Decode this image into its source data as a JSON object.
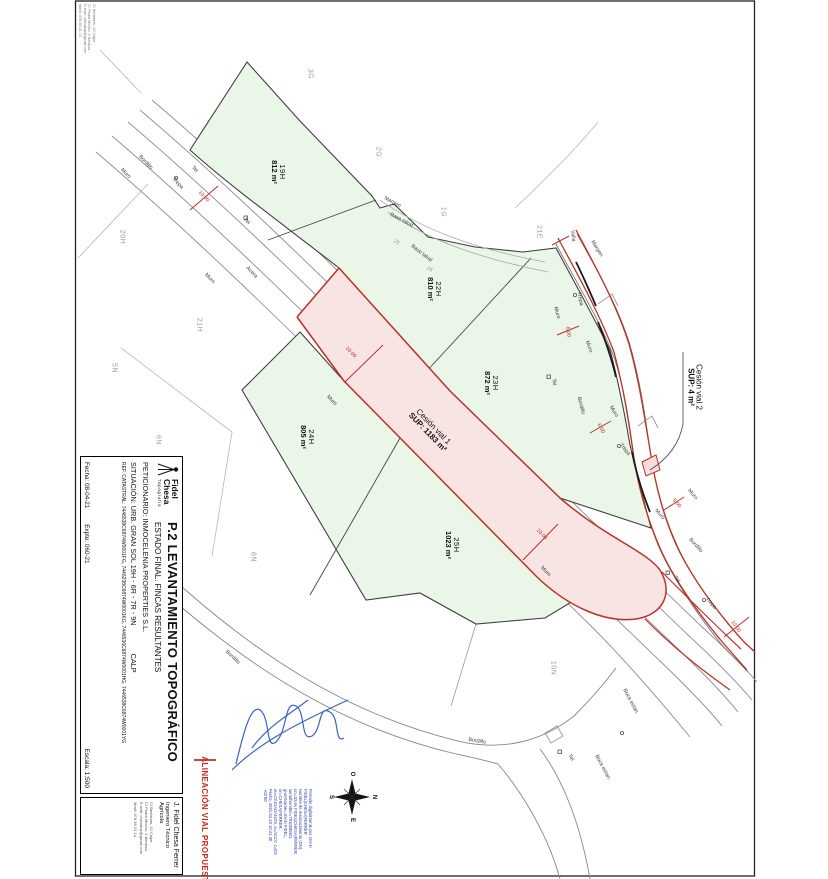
{
  "sheet": {
    "title": "P.2 LEVANTAMIENTO TOPOGRÁFICO",
    "subtitle": "ESTADO FINAL. FINCAS RESULTANTES",
    "peticionario_label": "PETICIONARIO:",
    "peticionario": "INMOCELENIA PROPERTIES S.L.",
    "situacion_label": "SITUACIÓN:",
    "situacion": "URB. GRAN SOL 19H - 6R - 7R - 9N",
    "municipio": "CALP",
    "ref_catastral_label": "REF. CATASTRAL:",
    "ref_catastral": "7446538C6874W0001FG, 7446238C6874W0001KG, 7446536C6874W0001HG, 7446538C6874W0001YG",
    "fecha_label": "Fecha:",
    "fecha": "08-04-21",
    "expte_label": "Expte:",
    "expte": "060-21",
    "escala_label": "Escala:",
    "escala": "1:500",
    "logo": {
      "name1": "Fidel",
      "name2": "Chesa",
      "tag": "Topografía"
    }
  },
  "professional": {
    "name": "J. Fidel Chesa Ferrer",
    "title": "Ingeniero Técnico Agrícola",
    "contact": [
      "C/ Benidorm, 10 Calpe",
      "C/ Pedra Mocho, 3 Benissa",
      "E-mail: chesatop@gmail.com",
      "Móvil: 678 69 21 14"
    ]
  },
  "corner_contact": {
    "lines": [
      "C/ Benidorm, 10 Calpe",
      "C/ Pedra Mocho, 3 Benissa",
      "E-mail: chesatop@gmail.com",
      "Móvil: 678 69 21 14"
    ]
  },
  "legend": {
    "label": "ALINEACIÓN VIAL PROPUESTA"
  },
  "digital_signature": {
    "lines": [
      "Firmado digitalmente por JOAN",
      "FIDEL|CHESA|FERRER",
      "Nombre de reconocimiento (DN):",
      "cn=JOAN FIDEL|CHESA|FERRER,",
      "serialNumber=79100996G,",
      "givenName=JOAN FIDEL,",
      "sn=CHESA|FERRER,",
      "ou=CIUDADANOS, o=ACCV, c=ES",
      "Fecha: 2021.04.23 10:41:30",
      "+02'00'"
    ]
  },
  "compass": {
    "n": "N",
    "s": "S",
    "e": "E",
    "w": "O"
  },
  "map": {
    "parcels": [
      {
        "id": "19H",
        "area": "812 m²",
        "x": 278,
        "y": 172
      },
      {
        "id": "22H",
        "area": "810 m²",
        "x": 434,
        "y": 289
      },
      {
        "id": "23H",
        "area": "872 m²",
        "x": 491,
        "y": 383
      },
      {
        "id": "24H",
        "area": "805 m²",
        "x": 307,
        "y": 437
      },
      {
        "id": "25H",
        "area": "1023 m²",
        "x": 452,
        "y": 545
      }
    ],
    "cessions": [
      {
        "name": "Cesión vial 1",
        "sup": "SUP: 1183 m²",
        "x": 430,
        "y": 430,
        "r": 46
      },
      {
        "name": "Cesión vial 2",
        "sup": "SUP: 4 m²",
        "x": 694,
        "y": 387,
        "r": 90
      }
    ],
    "neighbors": [
      {
        "t": "3G",
        "x": 310,
        "y": 74
      },
      {
        "t": "2G",
        "x": 378,
        "y": 152
      },
      {
        "t": "1G",
        "x": 443,
        "y": 212
      },
      {
        "t": "21E",
        "x": 539,
        "y": 232
      },
      {
        "t": "20H",
        "x": 122,
        "y": 237
      },
      {
        "t": "21H",
        "x": 199,
        "y": 325
      },
      {
        "t": "5N",
        "x": 114,
        "y": 368
      },
      {
        "t": "6N",
        "x": 158,
        "y": 440
      },
      {
        "t": "8N",
        "x": 253,
        "y": 557
      },
      {
        "t": "10N",
        "x": 553,
        "y": 668
      }
    ],
    "road_labels": [
      {
        "t": "Bordillo",
        "x": 145,
        "y": 163,
        "r": 46
      },
      {
        "t": "Muro",
        "x": 125,
        "y": 174,
        "r": 46
      },
      {
        "t": "Trepa",
        "x": 177,
        "y": 184,
        "r": 46
      },
      {
        "t": "Tel",
        "x": 194,
        "y": 170,
        "r": 46
      },
      {
        "t": "Tel",
        "x": 246,
        "y": 222,
        "r": 46
      },
      {
        "t": "Muro",
        "x": 209,
        "y": 279,
        "r": 46
      },
      {
        "t": "Acera",
        "x": 251,
        "y": 273,
        "r": 46
      },
      {
        "t": "Muro",
        "x": 331,
        "y": 401,
        "r": 46
      },
      {
        "t": "Muro",
        "x": 545,
        "y": 572,
        "r": 46
      },
      {
        "t": "Margen",
        "x": 392,
        "y": 203,
        "r": 28
      },
      {
        "t": "Base talud",
        "x": 401,
        "y": 221,
        "r": 28
      },
      {
        "t": "Base talud",
        "x": 421,
        "y": 254,
        "r": 38
      },
      {
        "t": "Margen",
        "x": 596,
        "y": 249,
        "r": 58
      },
      {
        "t": "Valla",
        "x": 572,
        "y": 236,
        "r": 82
      },
      {
        "t": "Muro",
        "x": 556,
        "y": 313,
        "r": 75
      },
      {
        "t": "Trepa",
        "x": 579,
        "y": 299,
        "r": 78
      },
      {
        "t": "Muro",
        "x": 588,
        "y": 347,
        "r": 70
      },
      {
        "t": "Tel",
        "x": 553,
        "y": 382,
        "r": 86
      },
      {
        "t": "Bordillo",
        "x": 580,
        "y": 406,
        "r": 76
      },
      {
        "t": "Muro",
        "x": 613,
        "y": 412,
        "r": 60
      },
      {
        "t": "Trepa",
        "x": 624,
        "y": 450,
        "r": 52
      },
      {
        "t": "Muro",
        "x": 692,
        "y": 495,
        "r": 48
      },
      {
        "t": "Muro",
        "x": 659,
        "y": 515,
        "r": 48
      },
      {
        "t": "Bordillo",
        "x": 695,
        "y": 546,
        "r": 48
      },
      {
        "t": "Tel",
        "x": 676,
        "y": 580,
        "r": 48
      },
      {
        "t": "Trepa",
        "x": 710,
        "y": 604,
        "r": 48
      },
      {
        "t": "Bordillo",
        "x": 232,
        "y": 658,
        "r": 44
      },
      {
        "t": "Bordillo",
        "x": 477,
        "y": 742,
        "r": 10
      },
      {
        "t": "Tel",
        "x": 570,
        "y": 758,
        "r": 60
      },
      {
        "t": "Boca estan.",
        "x": 602,
        "y": 768,
        "r": 62
      },
      {
        "t": "Boca estan.",
        "x": 630,
        "y": 702,
        "r": 62
      },
      {
        "t": "25",
        "x": 396,
        "y": 243,
        "r": 38,
        "c": "g"
      },
      {
        "t": "26",
        "x": 429,
        "y": 270,
        "r": 38,
        "c": "g"
      }
    ],
    "dims": [
      {
        "t": "10.00",
        "x": 203,
        "y": 197,
        "r": 46
      },
      {
        "t": "10.00",
        "x": 350,
        "y": 353,
        "r": 46
      },
      {
        "t": "10.00",
        "x": 541,
        "y": 535,
        "r": 46
      },
      {
        "t": "10.00",
        "x": 735,
        "y": 627,
        "r": 55
      },
      {
        "t": "6.00",
        "x": 567,
        "y": 332,
        "r": 80
      },
      {
        "t": "6.00",
        "x": 600,
        "y": 429,
        "r": 62
      },
      {
        "t": "6.00",
        "x": 676,
        "y": 504,
        "r": 48
      }
    ],
    "colors": {
      "parcel_fill": "#e9f6e8",
      "parcel_stroke": "#3f3f3f",
      "cession_fill": "#f9e4e4",
      "alignment_red": "#bb3226",
      "neighbor_label": "#9a9a9a",
      "signature_blue": "#3b63c4"
    }
  }
}
